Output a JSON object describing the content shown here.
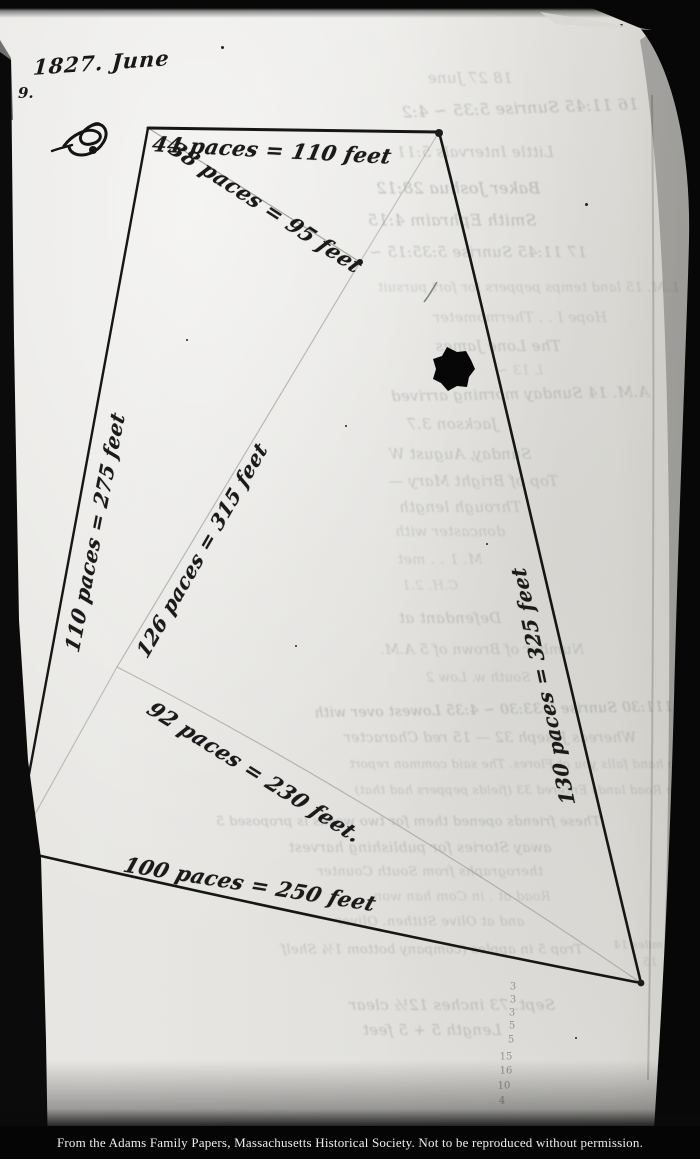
{
  "document": {
    "date_heading": "1827. June",
    "page_number": "9.",
    "caption": "From the Adams Family Papers, Massachusetts Historical Society. Not to be reproduced without permission."
  },
  "survey": {
    "measurements": [
      {
        "text": "44 paces = 110 feet",
        "x": 272,
        "y": 150,
        "rot": 3,
        "size": 21
      },
      {
        "text": "38 paces = 95 feet",
        "x": 266,
        "y": 207,
        "rot": 33,
        "size": 21
      },
      {
        "text": "110 paces = 275 feet",
        "x": 95,
        "y": 532,
        "rot": -79,
        "size": 20
      },
      {
        "text": "126 paces = 315 feet",
        "x": 202,
        "y": 550,
        "rot": -60,
        "size": 20
      },
      {
        "text": "130 paces = 325 feet",
        "x": 543,
        "y": 686,
        "rot": -102,
        "size": 20
      },
      {
        "text": "92 paces = 230 feet.",
        "x": 255,
        "y": 772,
        "rot": 32,
        "size": 21
      },
      {
        "text": "100 paces = 250 feet",
        "x": 250,
        "y": 884,
        "rot": 9,
        "size": 21
      }
    ]
  },
  "bleedthrough": {
    "lines": [
      {
        "text": "18 27 June",
        "x": 470,
        "y": 78,
        "size": 15,
        "op": 0.28
      },
      {
        "text": "16 11:45  Sunrise 5:35 ~ 4:2",
        "x": 520,
        "y": 108,
        "size": 16,
        "op": 0.35,
        "rot": -2
      },
      {
        "text": "Little Intervals 5:11",
        "x": 475,
        "y": 152,
        "size": 15,
        "op": 0.3
      },
      {
        "text": "Baker Joshua 28:12",
        "x": 458,
        "y": 188,
        "size": 16,
        "op": 0.38
      },
      {
        "text": "Smith Ephraim 4:15",
        "x": 452,
        "y": 220,
        "size": 16,
        "op": 0.35
      },
      {
        "text": "17 11:45  Sunrise 5:35:15 ~",
        "x": 478,
        "y": 252,
        "size": 15,
        "op": 0.32
      },
      {
        "text": "L.M. 15 land temps peppers for fort pursuit",
        "x": 528,
        "y": 288,
        "size": 13,
        "op": 0.25
      },
      {
        "text": "Hope I . . Thermometer",
        "x": 520,
        "y": 318,
        "size": 14,
        "op": 0.24
      },
      {
        "text": "The Lone James",
        "x": 498,
        "y": 346,
        "size": 15,
        "op": 0.3
      },
      {
        "text": "L 13 ~",
        "x": 520,
        "y": 371,
        "size": 13,
        "op": 0.22
      },
      {
        "text": "A.M. 14 Sunday morning arrived",
        "x": 520,
        "y": 394,
        "size": 15,
        "op": 0.32,
        "rot": -1
      },
      {
        "text": "Jackson 3.7",
        "x": 452,
        "y": 424,
        "size": 15,
        "op": 0.3
      },
      {
        "text": "Sunday, August W",
        "x": 460,
        "y": 454,
        "size": 15,
        "op": 0.3
      },
      {
        "text": "Top of Bright Mary —",
        "x": 473,
        "y": 481,
        "size": 15,
        "op": 0.28
      },
      {
        "text": "Through length",
        "x": 460,
        "y": 507,
        "size": 15,
        "op": 0.28
      },
      {
        "text": "doncaster with",
        "x": 450,
        "y": 532,
        "size": 14,
        "op": 0.25
      },
      {
        "text": "M. 1 . . met",
        "x": 440,
        "y": 560,
        "size": 14,
        "op": 0.24
      },
      {
        "text": "C.H. 2.1",
        "x": 430,
        "y": 586,
        "size": 13,
        "op": 0.22
      },
      {
        "text": "Defendant at",
        "x": 450,
        "y": 618,
        "size": 15,
        "op": 0.3
      },
      {
        "text": "Number of Brown of 5 A.M.",
        "x": 482,
        "y": 650,
        "size": 14,
        "op": 0.28
      },
      {
        "text": "South w. Low 2",
        "x": 478,
        "y": 678,
        "size": 13,
        "op": 0.25
      },
      {
        "text": "13 111:30  Sunrise 5:33:30 ~ 4:35  Lowest over with",
        "x": 505,
        "y": 710,
        "size": 14,
        "op": 0.38,
        "rot": -1
      },
      {
        "text": "Whereas Joseph 32 — 15 red Character",
        "x": 490,
        "y": 738,
        "size": 14,
        "op": 0.3
      },
      {
        "text": "two hand falls you at Flores. The said common report",
        "x": 520,
        "y": 764,
        "size": 12,
        "op": 0.28
      },
      {
        "text": "The Road lands Entered 33 (fields peppers had that)",
        "x": 522,
        "y": 790,
        "size": 12,
        "op": 0.28
      },
      {
        "text": "These friends opened them for two weeks is proposed 5",
        "x": 408,
        "y": 822,
        "size": 13,
        "op": 0.32
      },
      {
        "text": "away Stories for publishing harvest",
        "x": 420,
        "y": 848,
        "size": 14,
        "op": 0.3
      },
      {
        "text": "therographs from South Counter",
        "x": 430,
        "y": 872,
        "size": 13,
        "op": 0.28
      },
      {
        "text": "Road at . in Com han won",
        "x": 462,
        "y": 897,
        "size": 13,
        "op": 0.24
      },
      {
        "text": "and at Olive Stithen. Oliver",
        "x": 430,
        "y": 922,
        "size": 13,
        "op": 0.28
      },
      {
        "text": "Trop 5 in apples (company bottom 1¾ Shelf",
        "x": 432,
        "y": 950,
        "size": 13,
        "op": 0.3
      },
      {
        "text": "miles 14",
        "x": 638,
        "y": 945,
        "size": 11,
        "op": 0.28
      },
      {
        "text": "15",
        "x": 650,
        "y": 962,
        "size": 11,
        "op": 0.26
      },
      {
        "text": "Sept. 73 inches 12½ clear",
        "x": 452,
        "y": 1005,
        "size": 15,
        "op": 0.32
      },
      {
        "text": "Length 5 + 5 feet",
        "x": 432,
        "y": 1030,
        "size": 15,
        "op": 0.32
      }
    ]
  },
  "pencil_marks": [
    {
      "text": "3",
      "x": 513,
      "y": 987
    },
    {
      "text": "3",
      "x": 513,
      "y": 1000
    },
    {
      "text": "3",
      "x": 512,
      "y": 1013
    },
    {
      "text": "5",
      "x": 512,
      "y": 1026
    },
    {
      "text": "5",
      "x": 511,
      "y": 1040
    },
    {
      "text": "15",
      "x": 506,
      "y": 1057
    },
    {
      "text": "16",
      "x": 506,
      "y": 1071
    },
    {
      "text": "10",
      "x": 504,
      "y": 1086
    },
    {
      "text": "4",
      "x": 502,
      "y": 1101
    }
  ]
}
